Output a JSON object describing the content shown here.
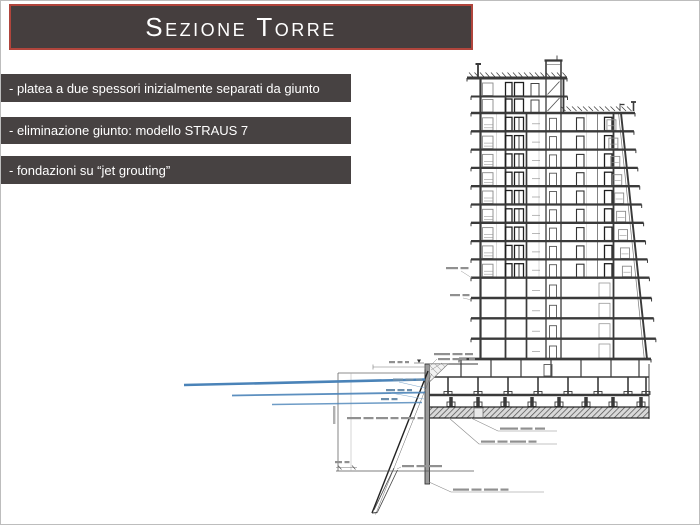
{
  "slide": {
    "title": "Sezione Torre",
    "bullets": [
      "- platea a due spessori inizialmente separati da giunto",
      "- eliminazione giunto: modello STRAUS 7",
      "- fondazioni su “jet grouting”"
    ],
    "colors": {
      "page_bg": "#ffffff",
      "border": "#bdbdbd",
      "title_bg": "#453e3e",
      "title_text": "#ffffff",
      "title_border": "#b0453c",
      "bullet_bg": "#474242",
      "bullet_text": "#ffffff",
      "drawing_line": "#3a3a3a",
      "drawing_light": "#909090",
      "anchor_blue": "#4a83b8"
    },
    "drawing": {
      "subject": "tower-cross-section",
      "storeys_above_ground": 15,
      "basement_levels": 2,
      "ground_anchor_lines": 3,
      "has_jet_grouting_pile": true,
      "has_foundation_slab_hatch": true
    }
  }
}
